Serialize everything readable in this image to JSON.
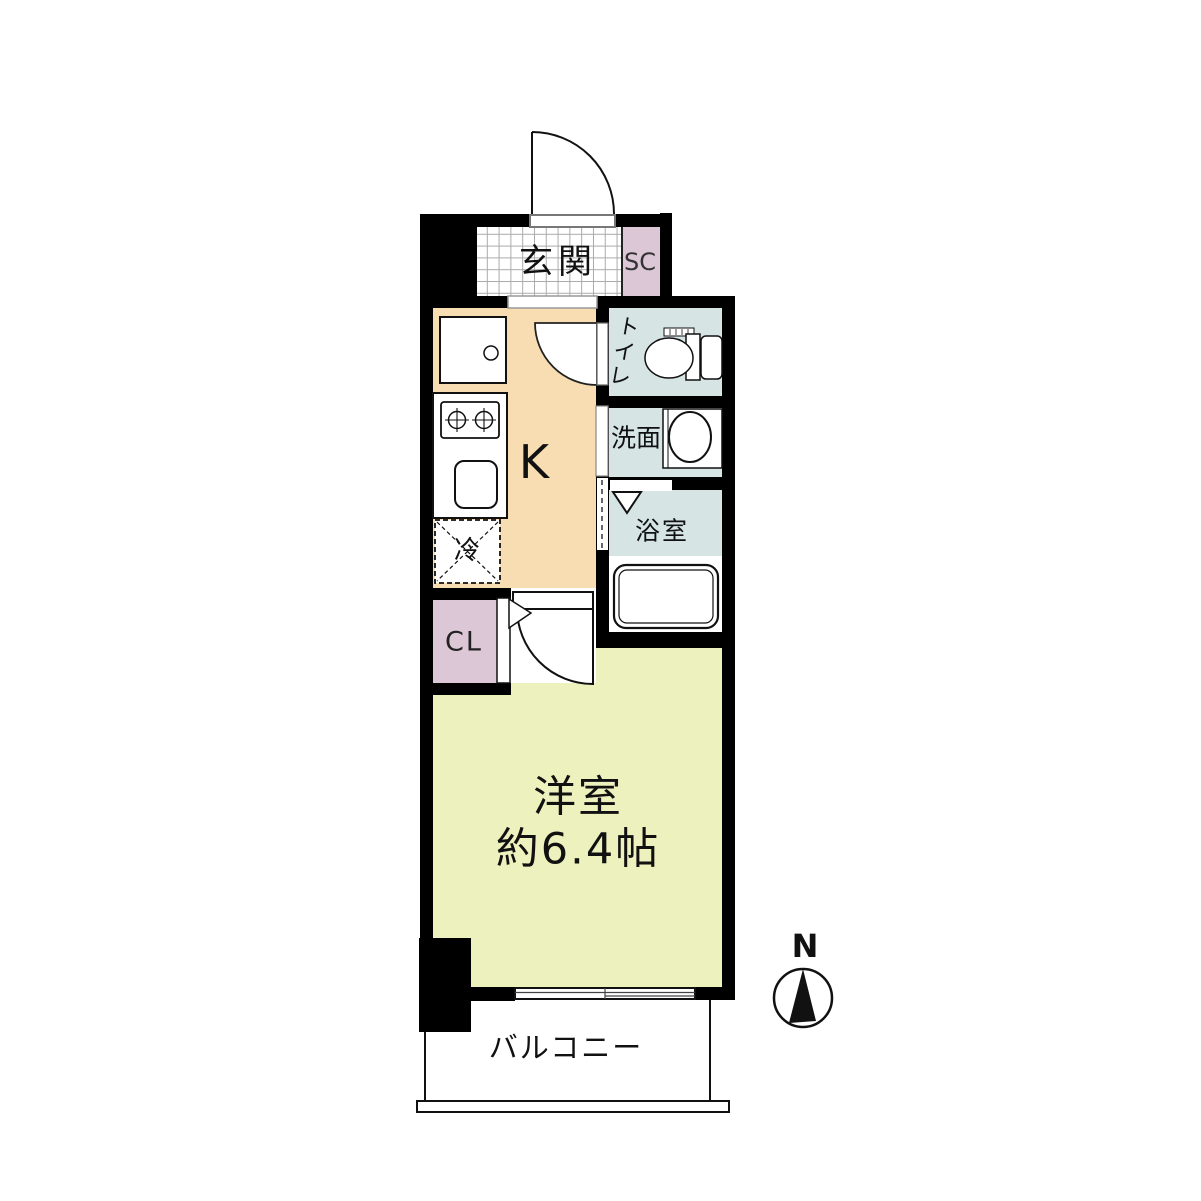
{
  "plan": {
    "rooms": {
      "entrance": {
        "label": "玄関"
      },
      "shoe_closet": {
        "label": "SC"
      },
      "toilet": {
        "label": "トイレ"
      },
      "washroom": {
        "label": "洗面"
      },
      "bathroom": {
        "label": "浴室"
      },
      "kitchen": {
        "label": "K"
      },
      "refrigerator_space": {
        "label": "冷"
      },
      "closet": {
        "label": "CL"
      },
      "main_room": {
        "label": "洋室",
        "size": "約6.4帖"
      },
      "balcony": {
        "label": "バルコニー"
      }
    },
    "compass": {
      "north_label": "N"
    },
    "colors": {
      "wall": "#000000",
      "kitchen_floor": "#f7ddb1",
      "wet_area": "#d6e4e4",
      "closet_fill": "#dcc7d6",
      "room_floor": "#edf1bd",
      "entrance_grid": "#aaaaaa"
    }
  }
}
